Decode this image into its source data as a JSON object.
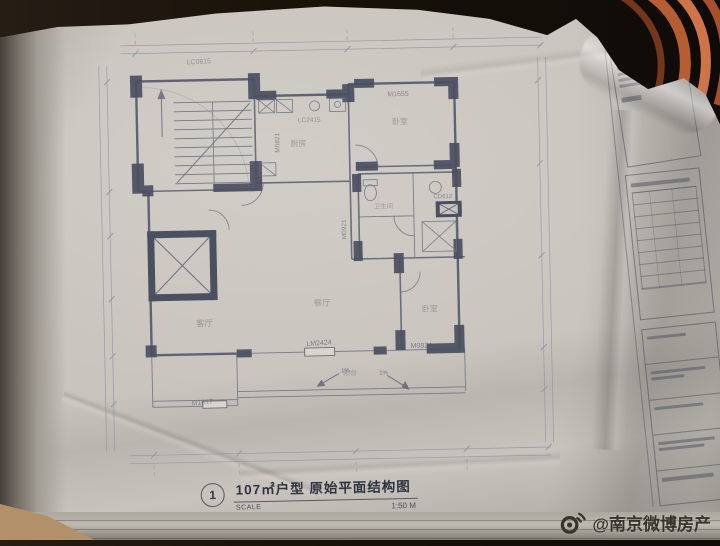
{
  "plan": {
    "figure_number": "1",
    "title": "107㎡户型 原始平面结构图",
    "scale_label": "SCALE",
    "scale_value": "1:50 M",
    "door_window_labels": {
      "top_window": "LC0815",
      "kitchen_door_vertical": "M0821",
      "kitchen_window": "LC2415",
      "bedroom_top_door": "M1655",
      "duct_label": "CD612",
      "bath_door_vertical": "M0921",
      "balcony_slider_left": "LM2424",
      "balcony_slider_right": "M0824",
      "bottom_left_door": "M1617"
    },
    "room_labels": {
      "kitchen": "厨房",
      "bedroom_top": "卧室",
      "bath": "卫生间",
      "living": "客厅",
      "dining": "餐厅",
      "bedroom_right": "卧室",
      "balcony": "阳台"
    },
    "slope_annotations": {
      "left": "1%",
      "right": "1%"
    }
  },
  "watermark": {
    "handle": "@南京微博房产",
    "icon": "weibo-logo-icon"
  },
  "colors": {
    "paper": "#c8c3bc",
    "ink": "#5c6172",
    "wall_fill": "#4b5061",
    "background": "#171108",
    "cable": "#c2683c",
    "watermark_text": "#39342b"
  }
}
